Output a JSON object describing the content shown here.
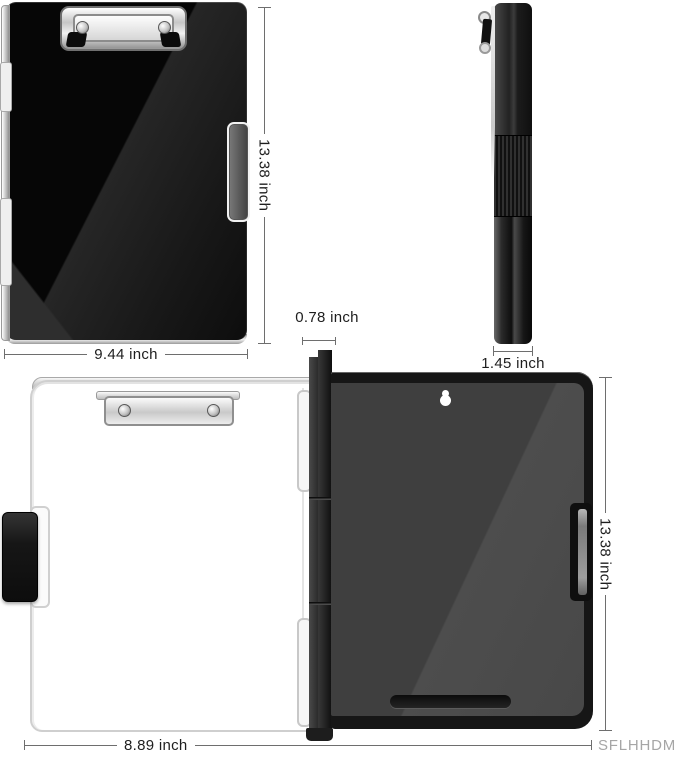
{
  "diagram": {
    "closed_front_view": {
      "height_label": "13.38 inch",
      "width_label": "9.44 inch"
    },
    "side_view": {
      "thickness_label": "1.45 inch"
    },
    "open_view": {
      "spine_label": "0.78 inch",
      "height_label": "13.38 inch",
      "width_label": "8.89 inch"
    },
    "watermark": "SFLHHDM",
    "colors": {
      "board_black": "#0d0d0d",
      "back_panel_gray": "#474747",
      "chrome_clip": "#d6d6d6",
      "dimension_line": "#6e6e6e",
      "label_text": "#1e1e1e",
      "watermark_text": "#a6a6a6",
      "background": "#ffffff"
    }
  }
}
